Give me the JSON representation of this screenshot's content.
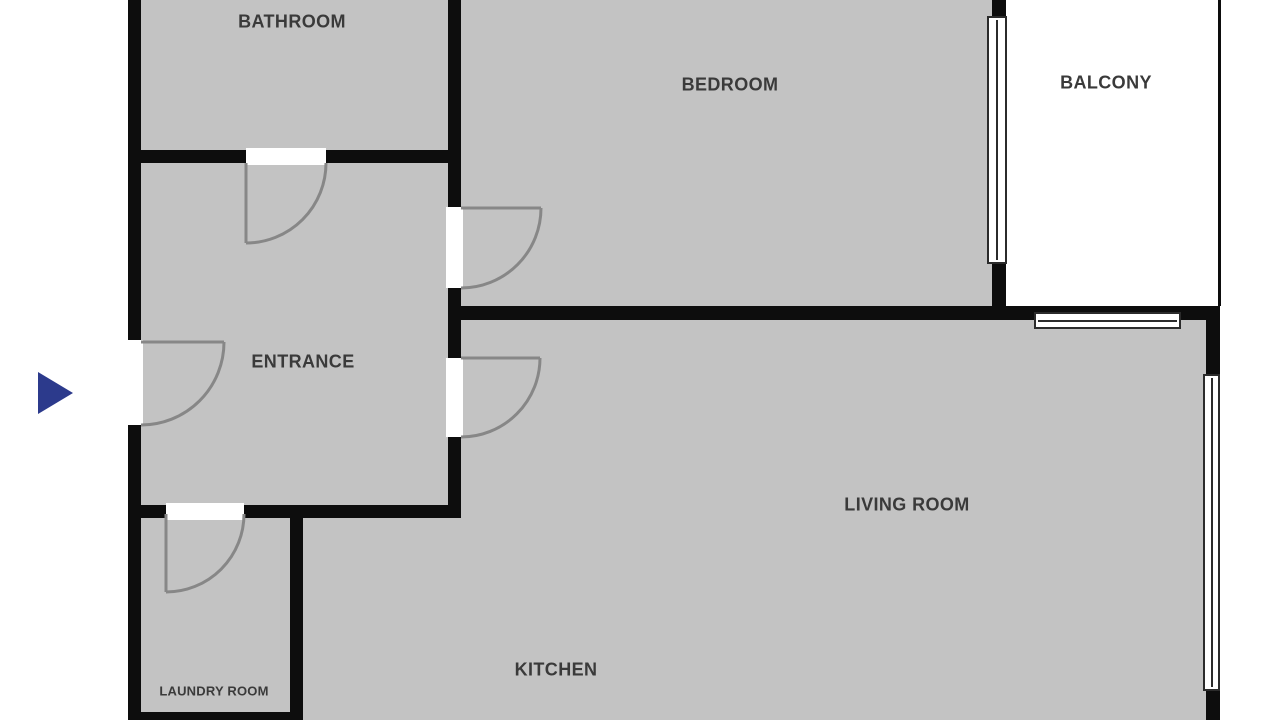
{
  "rooms": [
    {
      "id": "bathroom",
      "label": "BATHROOM"
    },
    {
      "id": "bedroom",
      "label": "BEDROOM"
    },
    {
      "id": "balcony",
      "label": "BALCONY"
    },
    {
      "id": "entrance",
      "label": "ENTRANCE"
    },
    {
      "id": "living_room",
      "label": "LIVING ROOM"
    },
    {
      "id": "kitchen",
      "label": "KITCHEN"
    },
    {
      "id": "laundry_room",
      "label": "LAUNDRY ROOM"
    }
  ],
  "markers": {
    "entrance_arrow": {
      "icon": "right-pointing-triangle",
      "color": "#2c3a8c"
    }
  },
  "counts": {
    "doors": 5,
    "windows": 3
  },
  "colors": {
    "background": "#ffffff",
    "room_fill": "#c3c3c3",
    "wall": "#0d0d0d",
    "door_arc": "#878787",
    "window_border": "#2b2b2b",
    "window_fill": "#ffffff",
    "label_text": "#3a3a3a",
    "arrow": "#2c3a8c"
  }
}
